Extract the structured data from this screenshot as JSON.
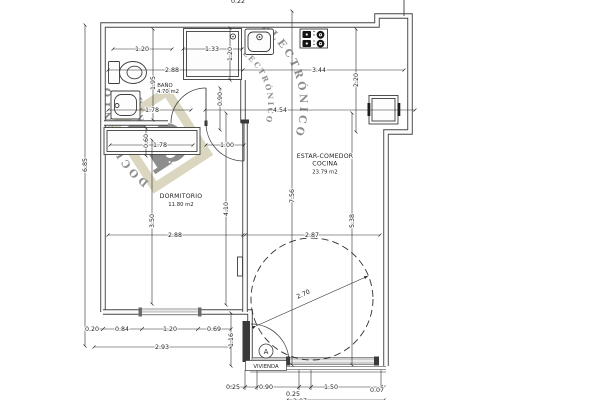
{
  "plan": {
    "rooms": {
      "bano": {
        "name": "BAÑO",
        "area": "4.70 m2"
      },
      "dormitorio": {
        "name": "DORMITORIO",
        "area": "11.80 m2"
      },
      "estar": {
        "line1": "ESTAR-COMEDOR",
        "line2": "COCINA",
        "area": "23.79 m2"
      }
    },
    "entrance": {
      "badge": "A",
      "label": "VIVIENDA"
    },
    "dims": {
      "d_top_cut": "0.22",
      "d_120_top": "1.20",
      "d_133": "1.33",
      "d_120_v": "1.20",
      "d_288_bath": "2.88",
      "d_344": "3.44",
      "d_195": "1.95",
      "d_220": "2.20",
      "d_178_bath": "1.78",
      "d_454": "4.54",
      "d_090_hall": "0.90",
      "d_060": "0.60",
      "d_178_closet": "1.78",
      "d_100": "1.00",
      "d_685": "6.85",
      "d_350": "3.50",
      "d_410": "4.10",
      "d_288_dorm": "2.88",
      "d_756": "7.56",
      "d_538": "5.38",
      "d_287": "2.87",
      "d_270": "2.70",
      "d_020": "0.20",
      "d_084": "0.84",
      "d_120_win": "1.20",
      "d_069": "0.69",
      "d_293": "2.93",
      "d_116": "1.16",
      "d_025_a": "0.25",
      "d_090_door": "0.90",
      "d_025_b": "0.25",
      "d_150": "1.50",
      "d_007": "0.07",
      "d_207": "2.07"
    },
    "watermark": {
      "arc_text_1": "DOCUMENTO",
      "arc_text_2": "ELECTRÓNICO",
      "glyph": "b"
    },
    "colors": {
      "line": "#3d3d3d",
      "dim_text": "#1e1e1e",
      "watermark": "#b7ae82",
      "sill": "#cdcdcd"
    }
  }
}
